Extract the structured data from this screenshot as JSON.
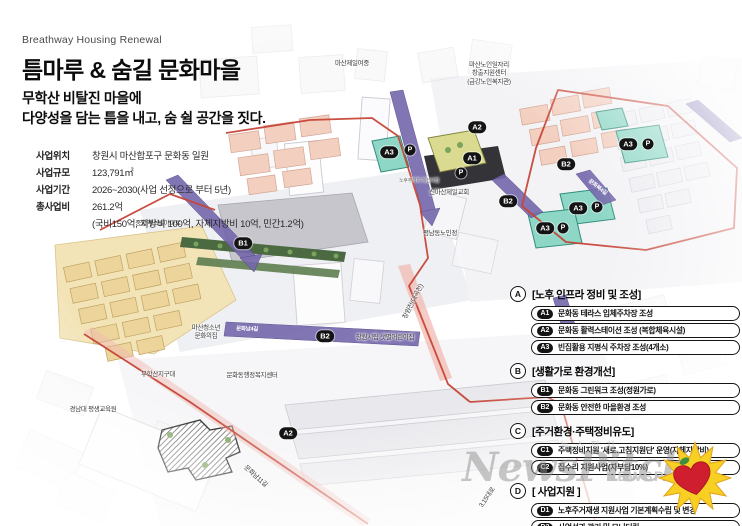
{
  "header": {
    "eyebrow": "Breathway Housing Renewal",
    "title": "틈마루 & 숨길 문화마을",
    "subtitle_line1": "무학산 비탈진 마을에",
    "subtitle_line2": "다양성을 담는  틈을 내고, 숨 쉴 공간을 짓다."
  },
  "project_info": {
    "rows": [
      {
        "label": "사업위치",
        "value": "창원시 마산합포구 문화동 일원"
      },
      {
        "label": "사업규모",
        "value": "123,791㎡"
      },
      {
        "label": "사업기간",
        "value": "2026~2030(사업 선정으로 부터 5년)"
      },
      {
        "label": "총사업비",
        "value": "261.2억"
      },
      {
        "label": "",
        "value": "(국비150억, 지방비 100억, 자체지방비 10억, 민간1.2억)"
      }
    ]
  },
  "legend": {
    "sections": [
      {
        "id": "A",
        "title": "[노후 인프라 정비 및 조성]",
        "items": [
          {
            "code": "A1",
            "label": "문화동 테라스 입체주차장 조성"
          },
          {
            "code": "A2",
            "label": "문화동 활력스테이션 조성 (복합체육시설)"
          },
          {
            "code": "A3",
            "label": "빈집활용 지평식 주차장 조성(4개소)"
          }
        ]
      },
      {
        "id": "B",
        "title": "[생활가로 환경개선]",
        "items": [
          {
            "code": "B1",
            "label": "문화동 그린워크 조성(정원가로)"
          },
          {
            "code": "B2",
            "label": "문화동 안전한 마을환경 조성"
          }
        ]
      },
      {
        "id": "C",
        "title": "[주거환경·주택정비유도]",
        "items": [
          {
            "code": "C1",
            "label": "주택정비지원 '새로.고침지원단' 운영(자체지방비)"
          },
          {
            "code": "C2",
            "label": "집수리 지원사업(자부담10%)"
          }
        ]
      },
      {
        "id": "D",
        "title": "[ 사업지원 ]",
        "items": [
          {
            "code": "D1",
            "label": "노후주거재생 지원사업 기본계획수립 및 변경"
          },
          {
            "code": "D2",
            "label": "사업성과 관리 및 모니터링"
          }
        ]
      }
    ]
  },
  "map": {
    "badges": [
      {
        "label": "A2"
      },
      {
        "label": "A3"
      },
      {
        "label": "P"
      },
      {
        "label": "A1"
      },
      {
        "label": "P"
      },
      {
        "label": "B1"
      },
      {
        "label": "B2"
      },
      {
        "label": "B2"
      },
      {
        "label": "A3"
      },
      {
        "label": "P"
      },
      {
        "label": "A3"
      },
      {
        "label": "P"
      },
      {
        "label": "A3"
      },
      {
        "label": "P"
      },
      {
        "label": "B2"
      },
      {
        "label": "A2"
      }
    ],
    "labels": [
      {
        "text": "마산제일여중"
      },
      {
        "text": "마산노인일자리\n창출지원센터\n(금강노인복지관)"
      },
      {
        "text": "중앙캐스빌아파트"
      },
      {
        "text": "신마산제일교회"
      },
      {
        "text": "평남동노인정"
      },
      {
        "text": "마산청소년\n문화의집"
      },
      {
        "text": "무학산지구대"
      },
      {
        "text": "문화동행정복지센터"
      },
      {
        "text": "창원시립 샛별어린이집"
      },
      {
        "text": "경남대 평생교육원"
      },
      {
        "text": "창원천(대곡천)"
      },
      {
        "text": "문화남11길"
      },
      {
        "text": "3.15대로"
      },
      {
        "text": "노후주거지 개선사업"
      },
      {
        "text": "문화남4길"
      },
      {
        "text": "문화북4길"
      }
    ]
  },
  "watermark": {
    "korean": "뉴스핏치",
    "script": "NewsPitch",
    "caps": "NEWSPITCH"
  },
  "colors": {
    "badge_bg": "#141414",
    "boundary_red": "#c74437",
    "ribbon_purple": "#7567ab",
    "teal_zone": "#8ed7c6",
    "housing_beige": "#ecd49a",
    "pink_block": "#f3cfc0",
    "green_walk": "#4b6a42",
    "logo_heart": "#cf1f2e",
    "logo_star": "#f7d023"
  }
}
